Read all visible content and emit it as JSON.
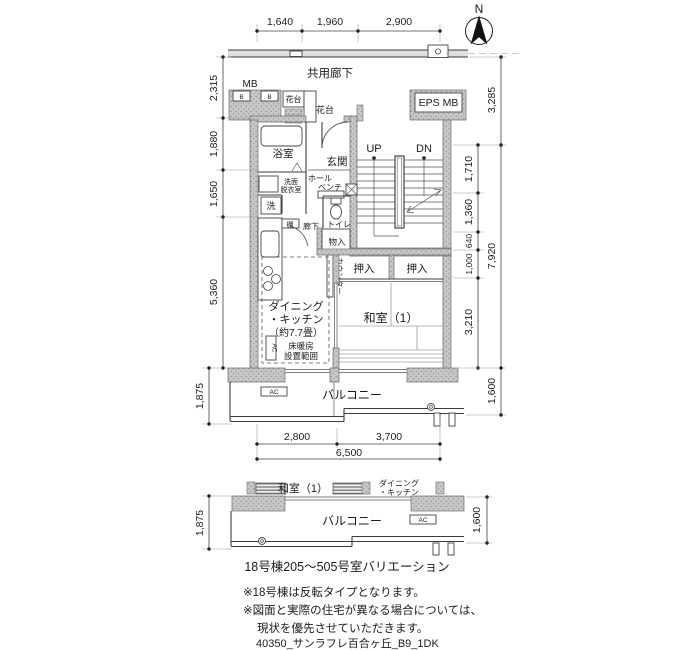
{
  "compass": {
    "north": "N"
  },
  "corridor": {
    "label": "共用廊下"
  },
  "top_dims": [
    "1,640",
    "1,960",
    "2,900"
  ],
  "left_dims": [
    "2,315",
    "1,880",
    "1,650",
    "5,360",
    "1,875"
  ],
  "right_dims_inner": [
    "1,710",
    "1,360",
    "640",
    "1,000",
    "3,210"
  ],
  "right_dims_outer": [
    "3,285",
    "7,920",
    "1,600"
  ],
  "bottom_dims": [
    "2,800",
    "3,700",
    "6,500"
  ],
  "rooms": {
    "mb": "MB",
    "b_left": "B",
    "b_right": "B",
    "planter_box": "花台",
    "planter_side": "花台",
    "eps_mb": "EPS MB",
    "bath": "浴室",
    "entrance": "玄関",
    "wash_line1": "洗面",
    "wash_line2": "脱衣室",
    "hall": "ホール",
    "bench": "ベンチ",
    "washer": "洗",
    "shelf": "棚",
    "hallway": "廊下",
    "toilet": "トイレ",
    "storage": "物入",
    "counter": "カウンター",
    "closet_left": "押入",
    "closet_right": "押入",
    "washitsu": "和室（1）",
    "dk1": "ダイニング",
    "dk2": "・キッチン",
    "dk3": "（約7.7畳）",
    "heat1": "床暖房",
    "heat2": "設置範囲",
    "ac_wall": "AC",
    "ac_balcony": "AC",
    "balcony": "バルコニー",
    "up": "UP",
    "dn": "DN"
  },
  "variation": {
    "washitsu": "和室（1）",
    "dk1": "ダイニング",
    "dk2": "・キッチン",
    "balcony": "バルコニー",
    "ac": "AC",
    "dim_left": "1,875",
    "dim_right": "1,600"
  },
  "caption": "18号棟205〜505号室バリエーション",
  "notes": [
    "※18号棟は反転タイプとなります。",
    "※図面と実際の住宅が異なる場合については、",
    "現状を優先させていただきます。"
  ],
  "footer": "40350_サンラフレ百合ヶ丘_B9_1DK"
}
